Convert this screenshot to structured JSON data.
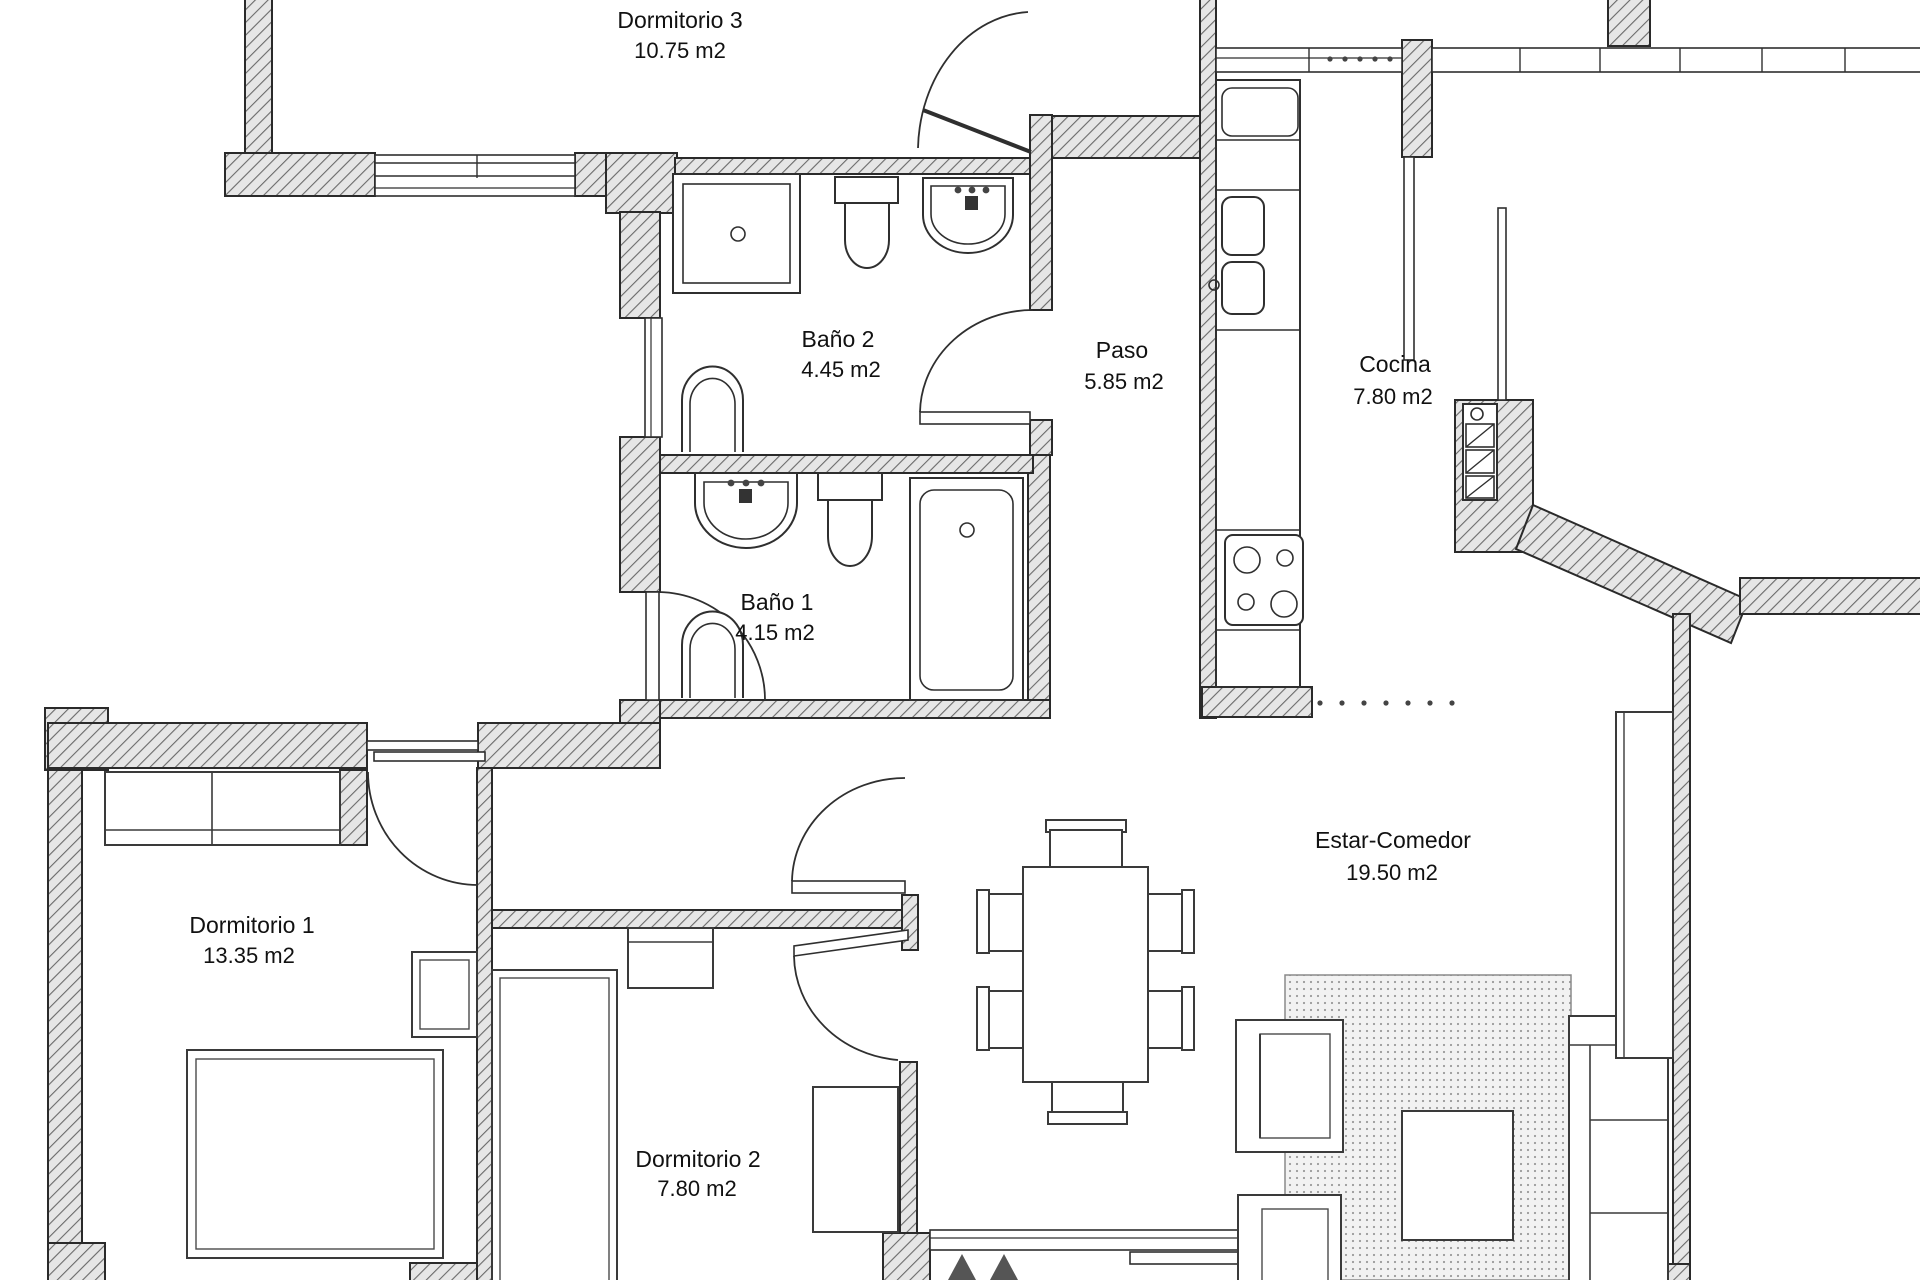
{
  "plan": {
    "type": "apartment-floor-plan",
    "rooms": [
      {
        "name": "Dormitorio 3",
        "area": "10.75 m2"
      },
      {
        "name": "Baño 2",
        "area": "4.45 m2"
      },
      {
        "name": "Paso",
        "area": "5.85 m2"
      },
      {
        "name": "Cocina",
        "area": "7.80 m2"
      },
      {
        "name": "Baño 1",
        "area": "4.15 m2"
      },
      {
        "name": "Dormitorio 1",
        "area": "13.35 m2"
      },
      {
        "name": "Estar-Comedor",
        "area": "19.50 m2"
      },
      {
        "name": "Dormitorio 2",
        "area": "7.80 m2"
      }
    ],
    "colors": {
      "ink": "#2a2a2a",
      "wall_fill": "#e6e6e6",
      "wall_hatch": "#6a6a6a",
      "rug_dot": "#9a9a9a",
      "background": "#ffffff"
    }
  }
}
